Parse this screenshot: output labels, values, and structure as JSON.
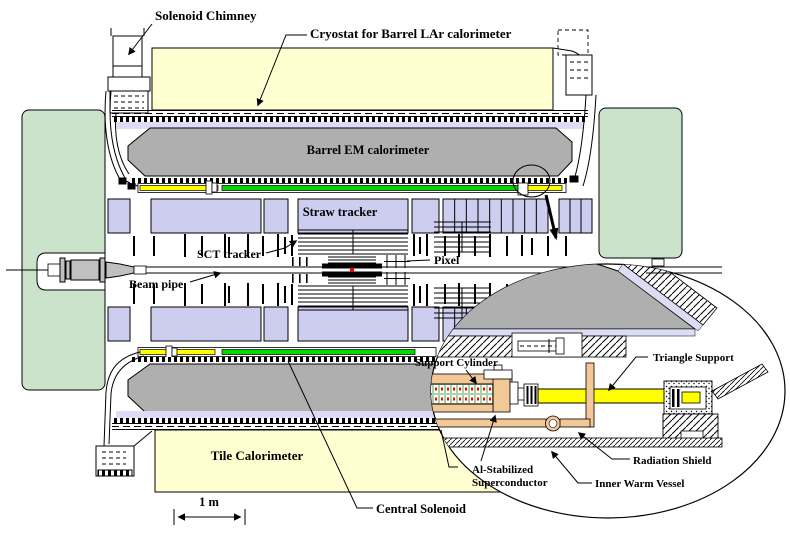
{
  "figure": {
    "type": "detector-cross-section-diagram",
    "labels": {
      "solenoid_chimney": "Solenoid Chimney",
      "cryostat_barrel_lar": "Cryostat for Barrel LAr calorimeter",
      "barrel_em_calorimeter": "Barrel EM calorimeter",
      "straw_tracker": "Straw tracker",
      "sct_tracker": "SCT tracker",
      "pixel": "Pixel",
      "beam_pipe": "Beam pipe",
      "tile_calorimeter": "Tile Calorimeter",
      "central_solenoid": "Central Solenoid",
      "scale_bar": "1 m"
    },
    "inset_labels": {
      "support_cylinder": "Support Cylinder",
      "triangle_support": "Triangle Support",
      "al_stabilized_line1": "Al-Stabilized",
      "al_stabilized_line2": "Superconductor",
      "radiation_shield": "Radiation Shield",
      "inner_warm_vessel": "Inner Warm Vessel"
    },
    "colors": {
      "tile_calorimeter_yellow": "#FFFFD2",
      "endcap_green": "#CBE3CB",
      "tracker_lavender": "#CDCDF0",
      "em_calorimeter_gray": "#AFAFAF",
      "solenoid_green": "#00D800",
      "solenoid_yellow": "#FFFF00",
      "support_cylinder_tan": "#F2C896",
      "liner_lavender": "#DCDCF5",
      "beam_fitting_gray": "#C0C0C0",
      "interaction_point_red": "#FF0000"
    }
  }
}
